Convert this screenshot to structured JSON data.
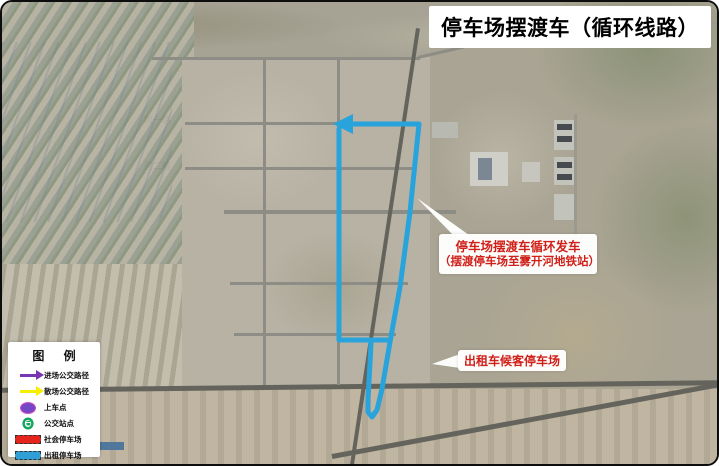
{
  "title": "停车场摆渡车（循环线路）",
  "colors": {
    "route_blue": "#29a3dc",
    "parking_red": "#e4251e",
    "taxi_blue": "#2f9fd6",
    "stop_green": "#12a55e",
    "legend_purple": "#7a35b5",
    "legend_yellow": "#f8ef00",
    "boarding_purple": "#7347c6",
    "annotation_red": "#d01f18"
  },
  "road_labels": [
    {
      "text": "雾一路",
      "x": 183,
      "y": 51,
      "orient": "h"
    },
    {
      "text": "开九街",
      "x": 256,
      "y": 66,
      "orient": "v"
    },
    {
      "text": "开十街",
      "x": 329,
      "y": 73,
      "orient": "v"
    },
    {
      "text": "丙一路",
      "x": 142,
      "y": 114,
      "orient": "h"
    },
    {
      "text": "丙二路",
      "x": 142,
      "y": 160,
      "orient": "h"
    },
    {
      "text": "雾二路",
      "x": 196,
      "y": 201,
      "orient": "h"
    },
    {
      "text": "雾三路",
      "x": 221,
      "y": 276,
      "orient": "h"
    },
    {
      "text": "雾六路",
      "x": 205,
      "y": 324,
      "orient": "h"
    },
    {
      "text": "东吉林大路",
      "x": 197,
      "y": 374,
      "orient": "h"
    }
  ],
  "parking_lots": [
    {
      "label": "P1",
      "x": 303,
      "y": 132,
      "w": 31,
      "h": 31
    },
    {
      "label": "P2",
      "x": 337,
      "y": 130,
      "w": 59,
      "h": 17
    },
    {
      "label": "P3",
      "x": 262,
      "y": 172,
      "w": 61,
      "h": 31
    },
    {
      "label": "P4",
      "x": 337,
      "y": 171,
      "w": 87,
      "h": 32,
      "clip": "polygon(0 0, 87% 0, 100% 100%, 0 100%)"
    },
    {
      "label": "P5",
      "x": 264,
      "y": 214,
      "w": 66,
      "h": 25
    },
    {
      "label": "P6",
      "x": 338,
      "y": 213,
      "w": 24,
      "h": 41
    },
    {
      "label": "P7",
      "x": 262,
      "y": 308,
      "w": 65,
      "h": 25
    },
    {
      "label": "P8",
      "x": 334,
      "y": 284,
      "w": 36,
      "h": 49,
      "clip": "polygon(8% 2%, 94% 6%, 76% 100%, 0 100%)"
    },
    {
      "label": "P9",
      "x": 262,
      "y": 340,
      "w": 65,
      "h": 26
    }
  ],
  "taxi_lot": {
    "x": 389,
    "y": 354,
    "w": 39,
    "h": 21
  },
  "bus_stops": [
    {
      "x": 332,
      "y": 190
    },
    {
      "x": 333,
      "y": 236
    },
    {
      "x": 332,
      "y": 322
    },
    {
      "x": 384,
      "y": 378
    },
    {
      "x": 377,
      "y": 406
    }
  ],
  "route": {
    "segments": [
      [
        [
          352,
          122
        ],
        [
          417,
          122
        ],
        [
          408,
          210
        ],
        [
          398,
          285
        ],
        [
          388,
          340
        ],
        [
          380,
          387
        ],
        [
          375,
          408
        ],
        [
          370,
          415
        ],
        [
          366,
          410
        ],
        [
          366,
          398
        ],
        [
          369,
          342
        ],
        [
          369,
          338
        ]
      ],
      [
        [
          337,
          127
        ],
        [
          337,
          338
        ],
        [
          386,
          338
        ]
      ]
    ],
    "arrow_head": "351,112 331,122 351,132"
  },
  "annotations": {
    "shuttle": {
      "lines": [
        "停车场摆渡车循环发车",
        "（摆渡停车场至雾开河地铁站）"
      ],
      "x": 437,
      "y": 232,
      "w": 158,
      "h": 40,
      "wedge": "415,196 452,234 474,238"
    },
    "taxi": {
      "text": "出租车候客停车场",
      "x": 456,
      "y": 348,
      "w": 108,
      "h": 21,
      "wedge": "430,362 458,352 458,366"
    }
  },
  "legend": {
    "title": "图 例",
    "items": [
      {
        "icon": "purple-arrow-icon",
        "label": "进场公交路径"
      },
      {
        "icon": "yellow-arrow-icon",
        "label": "散场公交路径"
      },
      {
        "icon": "boarding-point-icon",
        "label": "上车点"
      },
      {
        "icon": "bus-stop-icon",
        "label": "公交站点"
      },
      {
        "icon": "public-parking-swatch",
        "label": "社会停车场"
      },
      {
        "icon": "taxi-parking-swatch",
        "label": "出租停车场"
      }
    ]
  }
}
